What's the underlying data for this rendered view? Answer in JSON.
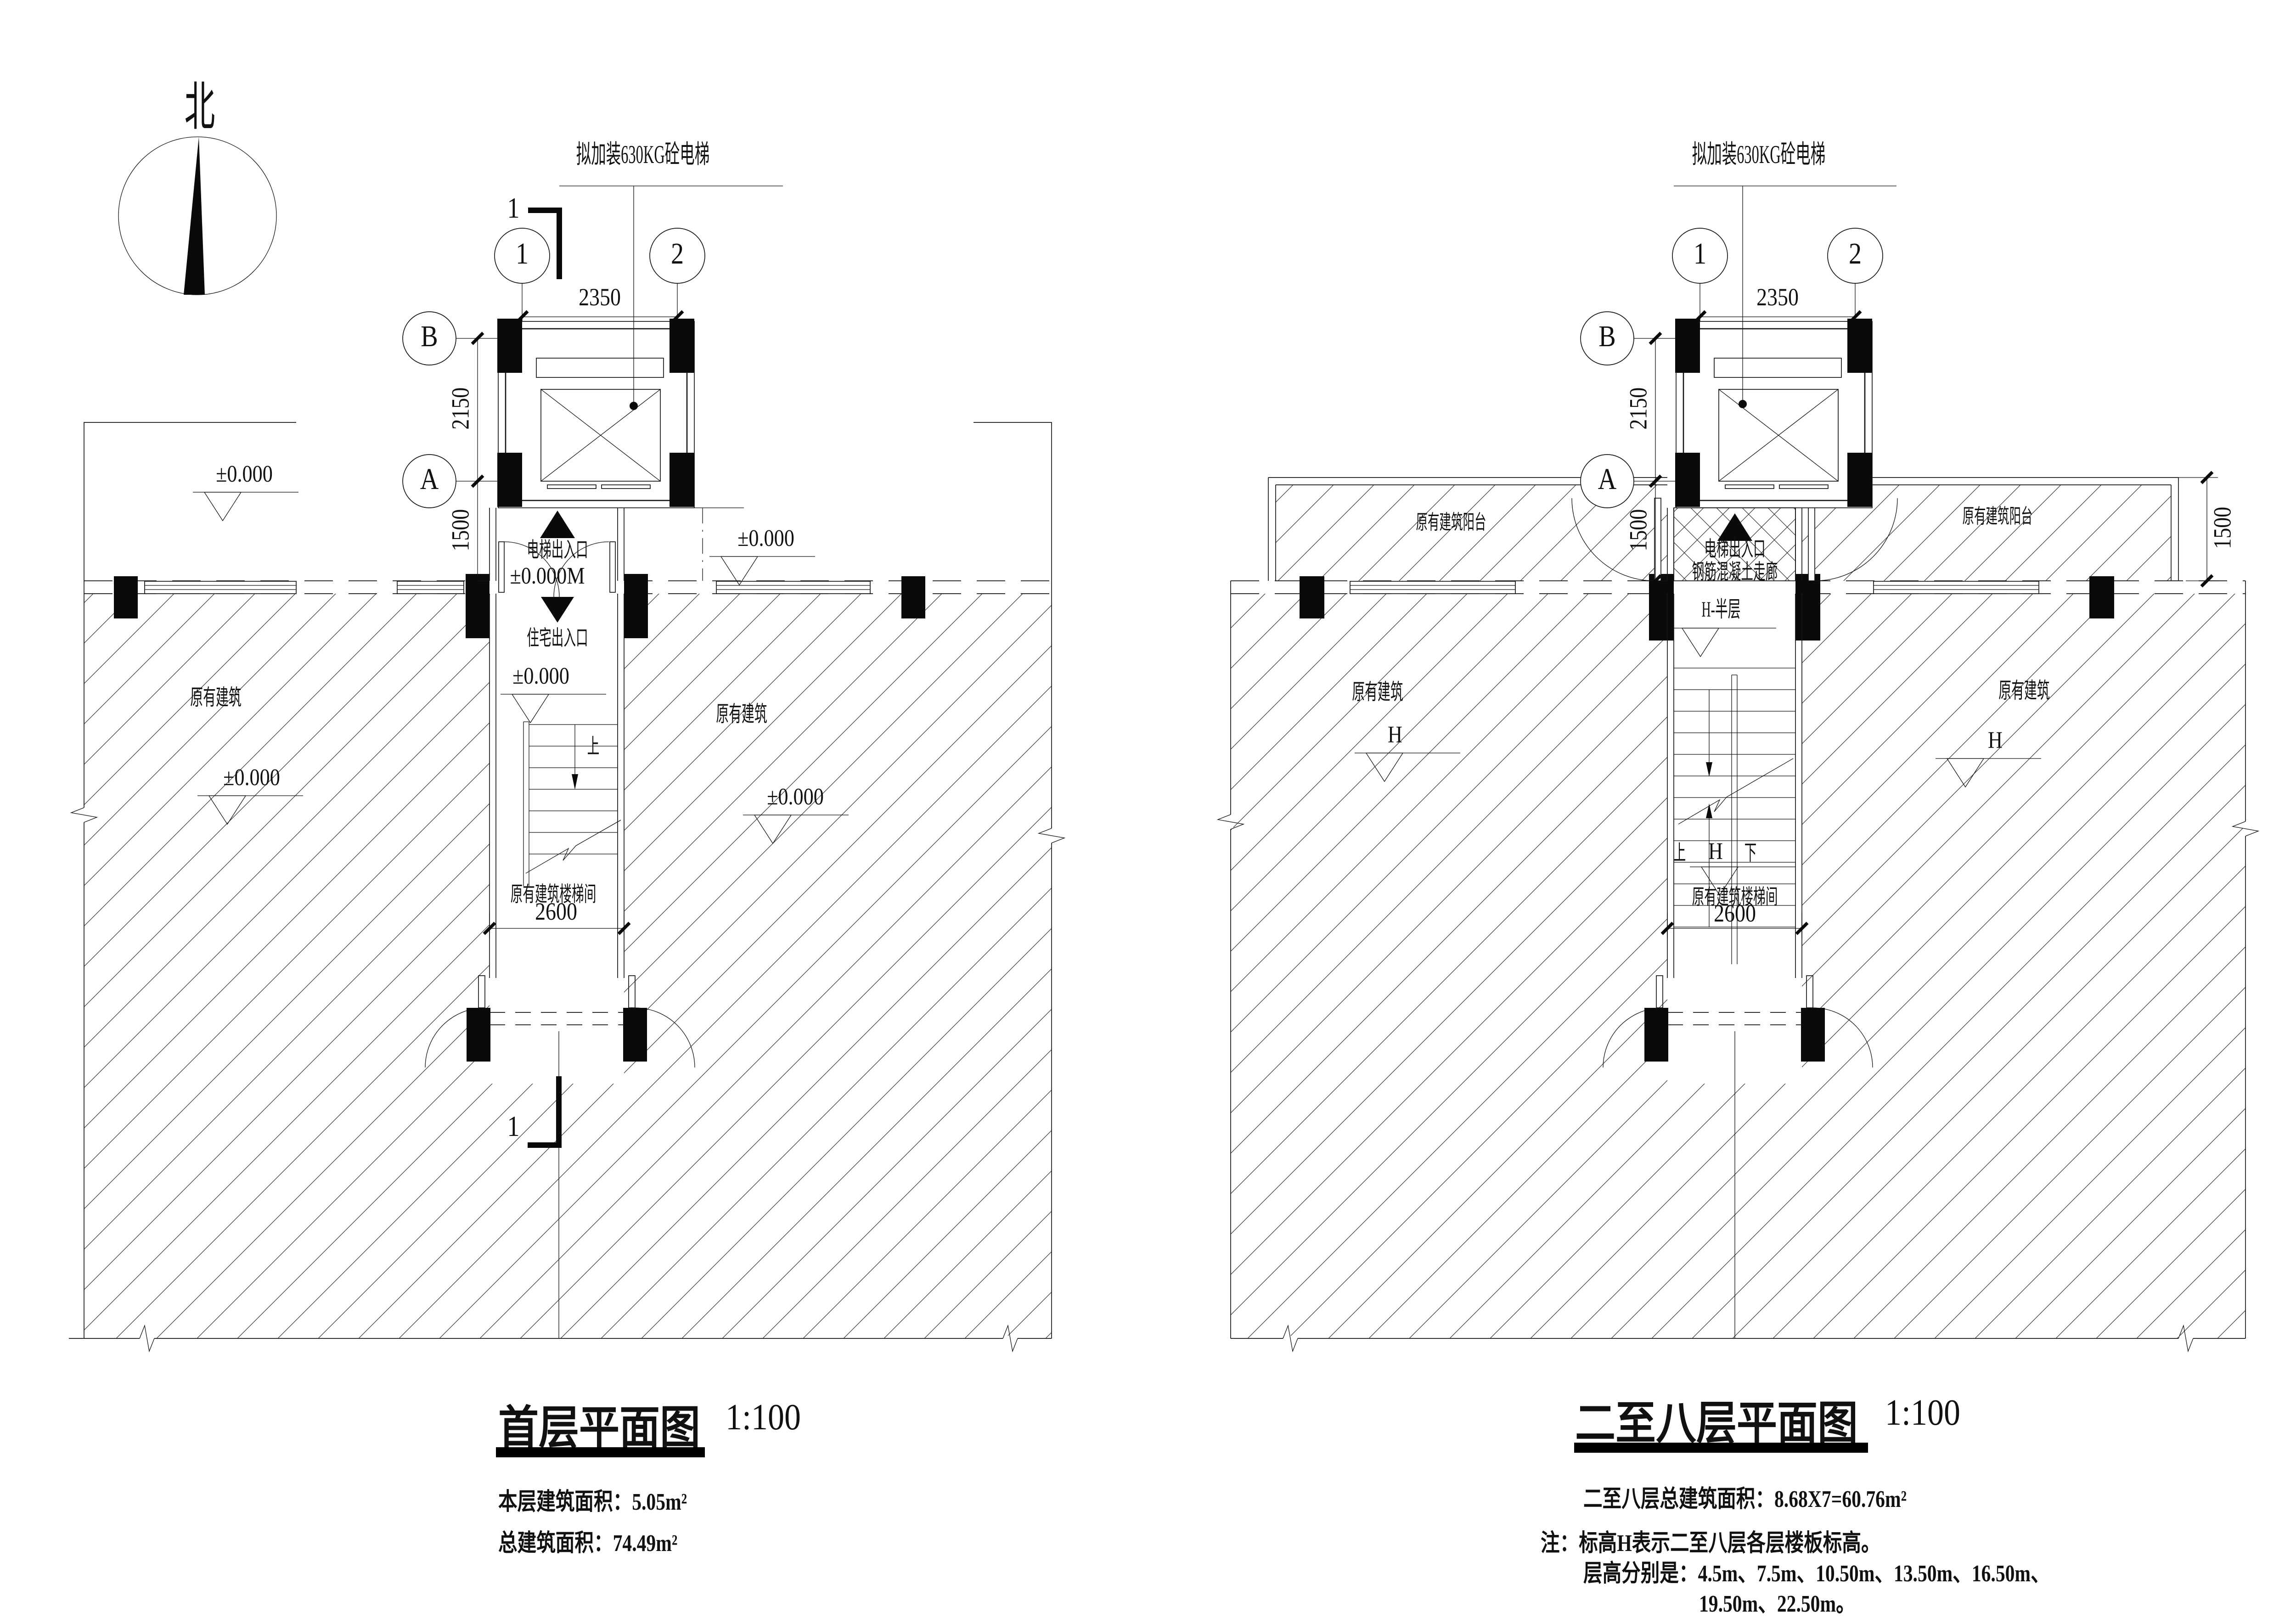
{
  "compass": {
    "north": "北"
  },
  "left_plan": {
    "leader": "拟加装630KG砼电梯",
    "grid": {
      "c1": "1",
      "c2": "2",
      "rB": "B",
      "rA": "A"
    },
    "dims": {
      "top": "2350",
      "height_upper": "2150",
      "height_lower": "1500",
      "stair_width": "2600"
    },
    "section": {
      "top": "1",
      "bottom": "1"
    },
    "labels": {
      "elevator_entrance": "电梯出入口",
      "elevator_entrance_level": "±0.000M",
      "residence_entrance": "住宅出入口",
      "level_zero": "±0.000",
      "up": "上",
      "stairwell": "原有建筑楼梯间",
      "existing_left": "原有建筑",
      "existing_right": "原有建筑"
    },
    "levels": {
      "outdoor_left": "±0.000",
      "outdoor_right": "±0.000",
      "hatch_left": "±0.000",
      "hatch_right": "±0.000"
    },
    "title": {
      "name": "首层平面图",
      "scale": "1:100"
    },
    "notes": {
      "floor_area": "本层建筑面积：5.05m²",
      "total_area": "总建筑面积：74.49m²"
    }
  },
  "right_plan": {
    "leader": "拟加装630KG砼电梯",
    "grid": {
      "c1": "1",
      "c2": "2",
      "rB": "B",
      "rA": "A"
    },
    "dims": {
      "top": "2350",
      "height_upper": "2150",
      "height_lower": "1500",
      "balcony_depth": "1500",
      "stair_width": "2600"
    },
    "labels": {
      "balcony_left": "原有建筑阳台",
      "balcony_right": "原有建筑阳台",
      "corridor_entrance": "电梯出入口",
      "corridor": "钢筋混凝土走廊",
      "half_level": "H-半层",
      "existing_left": "原有建筑",
      "existing_right": "原有建筑",
      "level_h_left": "H",
      "level_h_right": "H",
      "up": "上",
      "mid_level": "H",
      "down": "下",
      "stairwell": "原有建筑楼梯间"
    },
    "title": {
      "name": "二至八层平面图",
      "scale": "1:100"
    },
    "notes": {
      "total_area": "二至八层总建筑面积：8.68X7=60.76m²",
      "note1": "注：标高H表示二至八层各层楼板标高。",
      "note2": "层高分别是：4.5m、7.5m、10.50m、13.50m、16.50m、",
      "note3": "19.50m、22.50m。"
    }
  }
}
